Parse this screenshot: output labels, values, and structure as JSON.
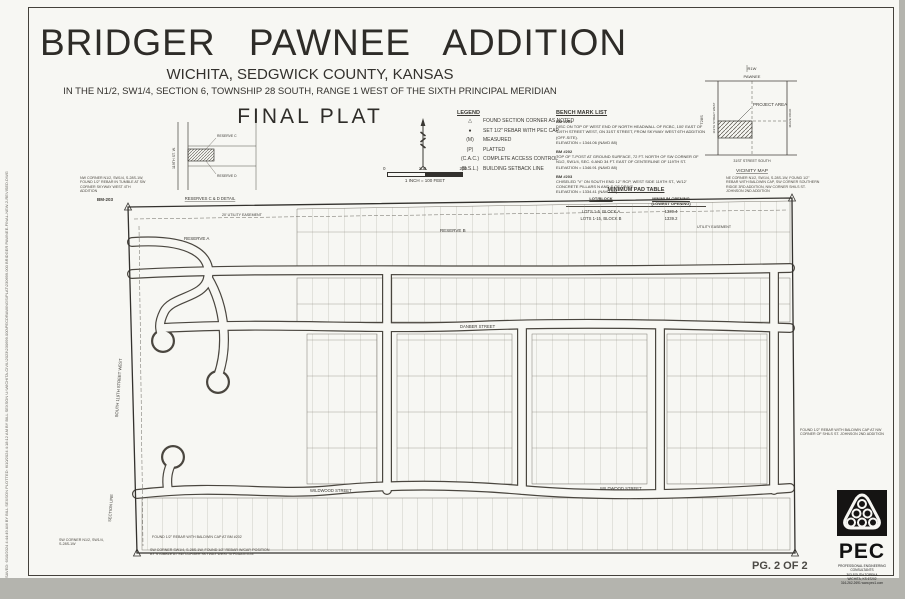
{
  "title_block": {
    "title": "BRIDGER PAWNEE ADDITION",
    "subtitle": "WICHITA, SEDGWICK COUNTY, KANSAS",
    "legal": "IN THE N1/2, SW1/4, SECTION 6, TOWNSHIP 28 SOUTH, RANGE 1 WEST OF THE SIXTH PRINCIPAL MERIDIAN",
    "plat_type": "FINAL PLAT"
  },
  "scale_bar": {
    "tick0": "0",
    "tick1": "100",
    "tick2": "200",
    "caption": "1 INCH = 100 FEET"
  },
  "legend": {
    "title": "LEGEND",
    "items": [
      {
        "symbol": "△",
        "label": "FOUND SECTION CORNER AS NOTED"
      },
      {
        "symbol": "●",
        "label": "SET 1/2\" REBAR WITH PEC CAP"
      },
      {
        "symbol": "(M)",
        "label": "MEASURED"
      },
      {
        "symbol": "(P)",
        "label": "PLATTED"
      },
      {
        "symbol": "(C.A.C.)",
        "label": "COMPLETE ACCESS CONTROL"
      },
      {
        "symbol": "(B.S.L.)",
        "label": "BUILDING SETBACK LINE"
      }
    ]
  },
  "benchmarks": {
    "title": "BENCH MARK LIST",
    "items": [
      {
        "id": "BM #201",
        "desc": "DISC ON TOP OF WEST END OF NORTH HEADWALL OF RCBC, 100' EAST OF 119TH STREET WEST, ON 31ST STREET, FROM SKYWAY WEST 6TH ADDITION (OFF-SITE).",
        "elev": "ELEVATION = 1344.06 (NAVD 88)"
      },
      {
        "id": "BM #202",
        "desc": "TOP OF T-POST AT GROUND SURFACE, 72 FT. NORTH OF SW CORNER OF N1/2, SW1/4, SEC. 6 AND 34 FT. EAST OF CENTERLINE OF 119TH ST.",
        "elev": "ELEVATION = 1346.91 (NAVD 88)"
      },
      {
        "id": "BM #203",
        "desc": "CHISELED \"V\" ON SOUTH END 12\" RCP, WEST SIDE 119TH ST., W/12' CONCRETE PILLARS N AND S OF DRIVE.",
        "elev": "ELEVATION = 1334.41 (NAVD 88)"
      }
    ]
  },
  "pad_table": {
    "title": "MINIMUM PAD TABLE",
    "col1": "LOT/BLOCK",
    "col2a": "MINIMUM OPENING",
    "col2b": "(LOWEST OPENING)",
    "rows": [
      {
        "lot": "LOTS 1-5, BLOCK A",
        "value": "1339.4"
      },
      {
        "lot": "LOTS 1-15, BLOCK B",
        "value": "1339.2"
      }
    ]
  },
  "vicinity": {
    "title": "VICINITY MAP",
    "range": "R1W",
    "township": "T28S",
    "north_road": "PAWNEE",
    "west_road": "119TH STREET WEST",
    "east_road": "MAIZE ROAD",
    "south_road": "31ST STREET SOUTH",
    "project_label": "PROJECT AREA"
  },
  "detail_inset": {
    "title": "RESERVES C & D DETAIL",
    "street": "119TH ST. W.",
    "reserve_c": "RESERVE C",
    "reserve_d": "RESERVE D"
  },
  "plat": {
    "reserve_a": "RESERVE A",
    "reserve_b": "RESERVE B",
    "easement_top": "20' UTILITY EASEMENT",
    "easement_right": "UTILITY EASEMENT",
    "street_wildwood_1": "WILDWOOD STREET",
    "street_wildwood_2": "WILDWOOD STREET",
    "street_danber": "DANBER STREET",
    "street_119th": "SOUTH 119TH STREET WEST",
    "section_line": "SECTION LINE",
    "bm203_tag": "BM-203",
    "notes": {
      "nw": "NW CORNER N1/2, SW1/4, S-28S-1W, FOUND 1/2\" REBAR IN TUMBLE AT SW CORNER SKYWAY WEST 4TH ADDITION",
      "ne": "NE CORNER N1/2, SW1/4, S-28S-1W, FOUND 1/2\" REBAR WITH BALDWIN CAP, SW CORNER SOUTHERN RIDGE 3RD ADDITION, NW CORNER SHILS ST. JOHNSON 2ND ADDITION",
      "east": "FOUND 1/2\" REBAR WITH BALDWIN CAP AT NW CORNER OF SHILS ST. JOHNSON 2ND ADDITION",
      "sw1": "SW CORNER N1/2, SW1/4, S-28S-1W",
      "sw2": "FOUND 1/2\" REBAR WITH BALDWIN CAP AT BM #202",
      "sw3": "SW CORNER SW1/4, S-28S-1W, FOUND 1/2\" REBAR W/CAP, POSITION BY STUBBLE AT SW CORNER SKYWAY WEST 4TH ADDITION"
    }
  },
  "pec": {
    "word": "PEC",
    "firm": "PROFESSIONAL ENGINEERING CONSULTANTS",
    "address1": "303 SOUTH TOPEKA",
    "address2": "WICHITA, KS 67202",
    "phone": "316-262-2691  www.pec1.com"
  },
  "page_label": "PG. 2 OF 2",
  "edge_text": "SAVED: 6/10/2024 4:44:49 AM BY BILL SEXSON    PLOTTED: 6/10/2024 4:18:12 AM BY BILL SEXSON    U:\\WICHITA-CIVIL\\2023\\230699.000\\PECDRAWINGS\\PLAT\\230699.000 BRIDGER PAWNEE-FINAL-NEW-2-REVISED.DWG"
}
